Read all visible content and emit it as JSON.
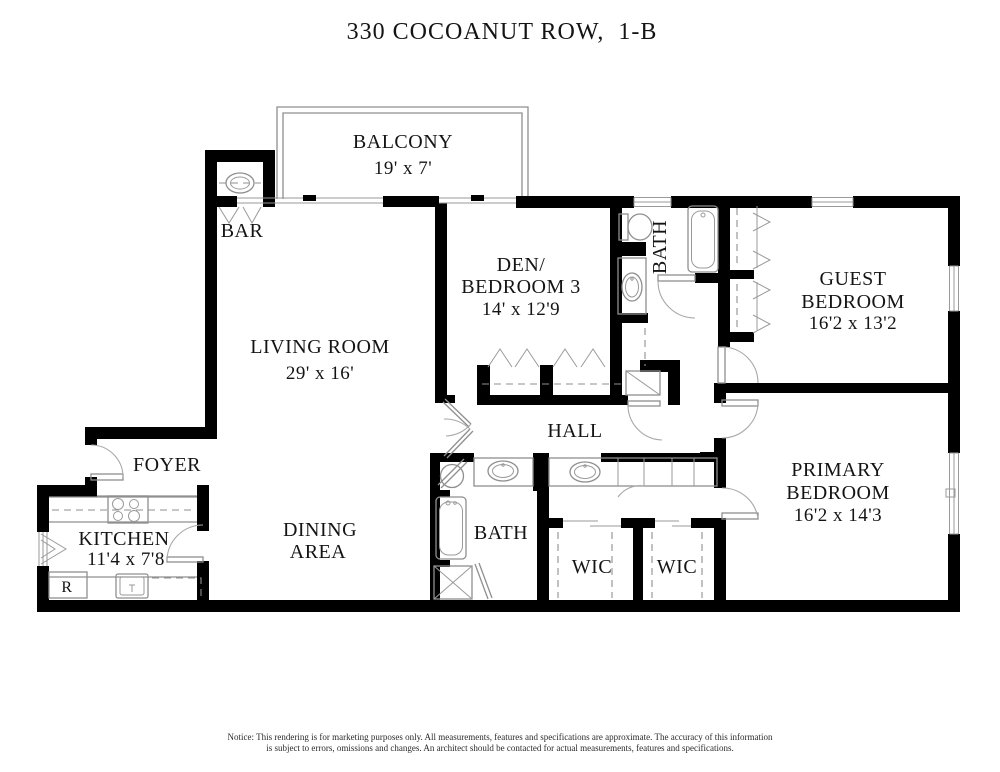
{
  "title": "330 COCOANUT ROW,  1-B",
  "rooms": {
    "balcony": {
      "name": "BALCONY",
      "dims": "19' x 7'"
    },
    "bar": {
      "name": "BAR"
    },
    "living_room": {
      "name": "LIVING ROOM",
      "dims": "29' x 16'"
    },
    "den_bedroom3": {
      "name_line1": "DEN/",
      "name_line2": "BEDROOM 3",
      "dims": "14' x 12'9"
    },
    "guest_bath": {
      "name": "BATH"
    },
    "guest_bedroom": {
      "name_line1": "GUEST",
      "name_line2": "BEDROOM",
      "dims": "16'2 x 13'2"
    },
    "hall": {
      "name": "HALL"
    },
    "foyer": {
      "name": "FOYER"
    },
    "kitchen": {
      "name": "KITCHEN",
      "dims": "11'4 x 7'8"
    },
    "dining_area": {
      "name_line1": "DINING",
      "name_line2": "AREA"
    },
    "primary_bath": {
      "name": "BATH"
    },
    "wic_left": {
      "name": "WIC"
    },
    "wic_right": {
      "name": "WIC"
    },
    "primary_bedroom": {
      "name_line1": "PRIMARY",
      "name_line2": "BEDROOM",
      "dims": "16'2 x 14'3"
    },
    "refrigerator": {
      "label": "R"
    }
  },
  "notice": {
    "line1": "Notice: This rendering is for marketing purposes only. All measurements, features and specifications are approximate. The accuracy of this information",
    "line2": "is subject to errors, omissions and changes. An architect should be contacted for actual measurements, features and specifications."
  },
  "colors": {
    "wall": "#000000",
    "fixture_line": "#8f8f8f",
    "label_text": "#141414",
    "background": "#ffffff"
  }
}
